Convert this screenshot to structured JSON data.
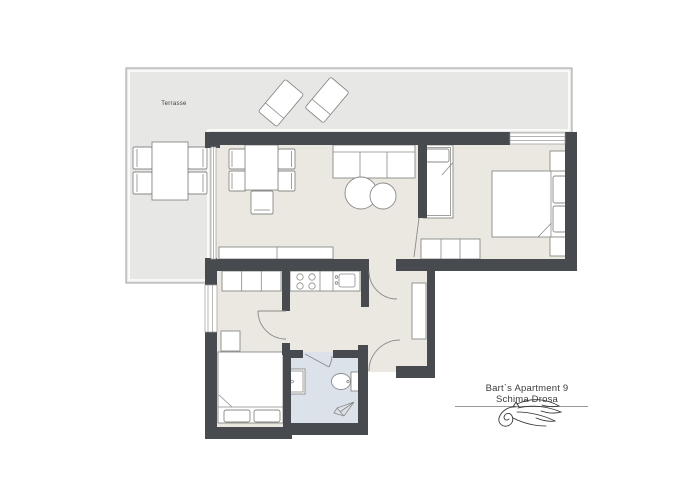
{
  "terrace": {
    "label": "Terrasse"
  },
  "branding": {
    "line1": "Bart`s Apartment 9",
    "line2": "Schima Drosa"
  },
  "colors": {
    "wall": "#474a4f",
    "floor": "#eae8e1",
    "terrace": "#e7e7e5",
    "terrace_border": "#a2a2a0",
    "bathroom_floor": "#dce2ea",
    "furniture_outline": "#8a8a88",
    "door_arc": "#8a8a88",
    "window_line": "#9a9a98",
    "text": "#3b3b3b",
    "logo": "#2e2e2e"
  }
}
